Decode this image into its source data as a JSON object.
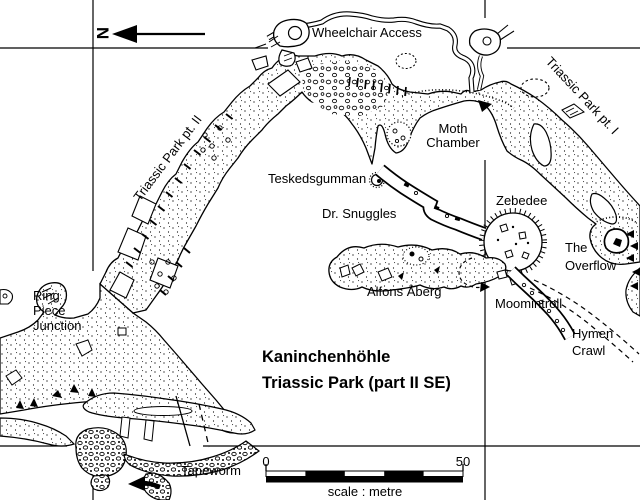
{
  "map": {
    "title": {
      "line1": "Kaninchenhöhle",
      "line2": "Triassic Park (part II SE)"
    },
    "north": {
      "label": "N"
    },
    "passage_labels": {
      "wheelchair_access": "Wheelchair Access",
      "triassic_park_pt1": "Triassic Park pt. I",
      "triassic_park_pt2": "Triassic Park pt. II",
      "moth_chamber": {
        "line1": "Moth",
        "line2": "Chamber"
      },
      "teskedsgumman": "Teskedsgumman",
      "dr_snuggles": "Dr. Snuggles",
      "zebedee": "Zebedee",
      "the_overflow": {
        "line1": "The",
        "line2": "Overflow"
      },
      "alfons_aberg": "Alfons Åberg",
      "moomintroll": "Moomintroll",
      "hymen_crawl": {
        "line1": "Hymen",
        "line2": "Crawl"
      },
      "ring_piece_junction": {
        "line1": "Ring",
        "line2": "Piece",
        "line3": "Junction"
      },
      "tapeworm": "Tapeworm"
    },
    "scale_bar": {
      "start_label": "0",
      "end_label": "50",
      "caption": "scale : metre"
    },
    "colors": {
      "ink": "#000000",
      "paper": "#ffffff"
    }
  }
}
